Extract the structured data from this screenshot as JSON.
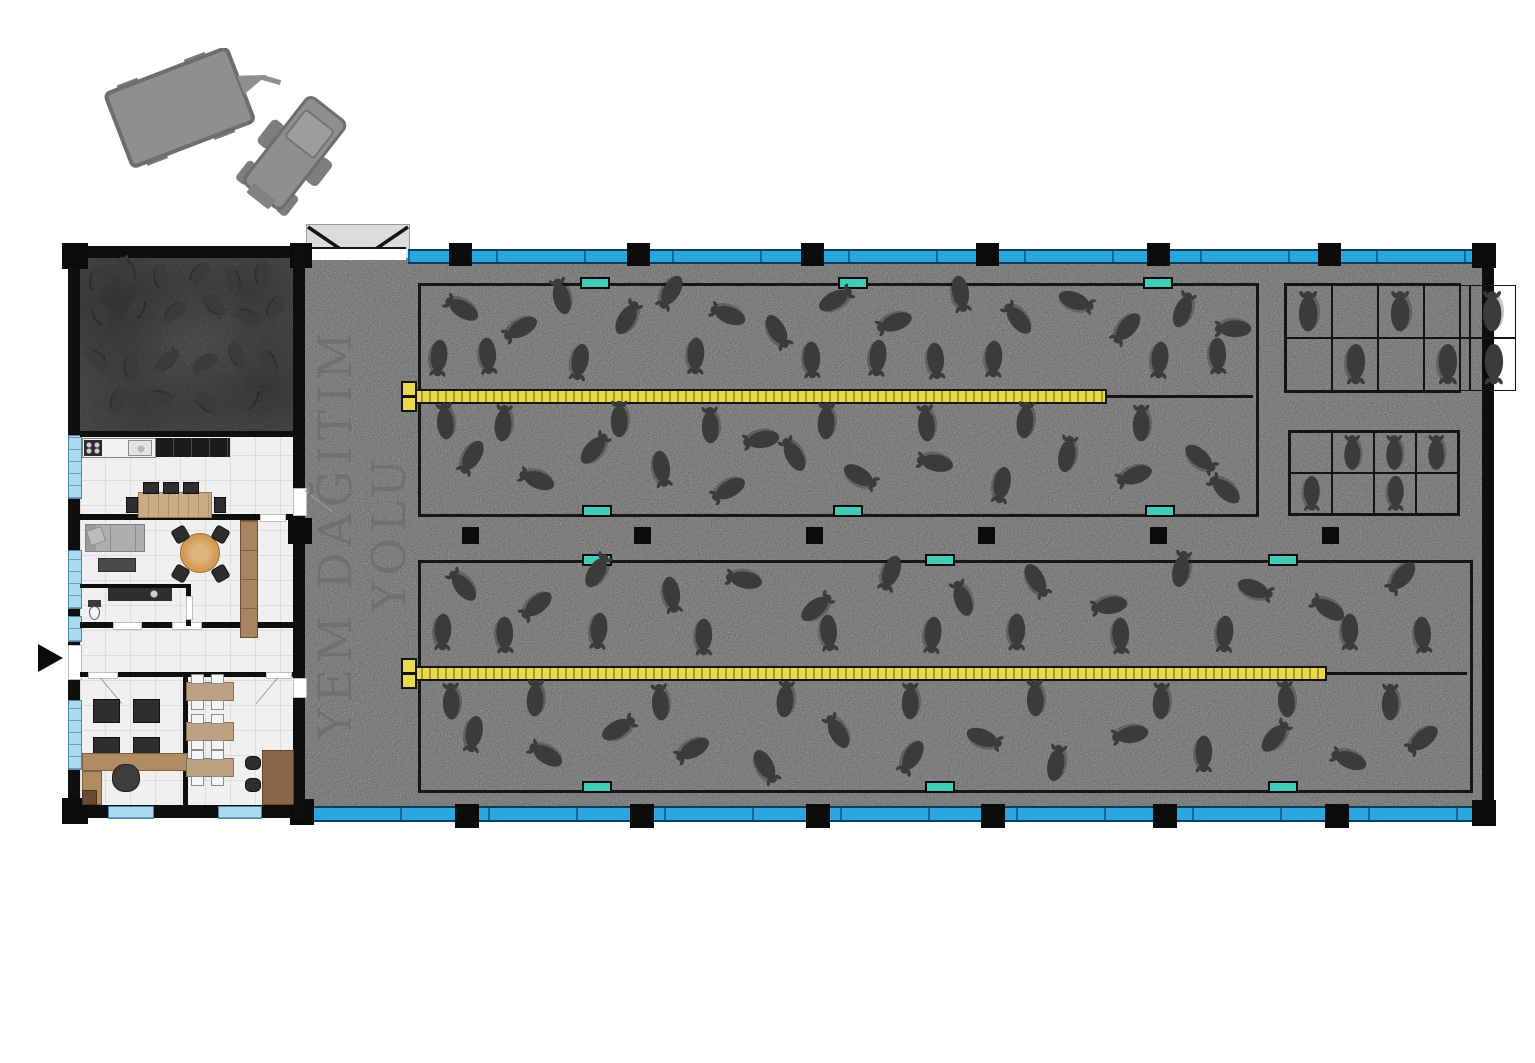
{
  "plan": {
    "corridor_label": "YEM DAĞITIM YOLU",
    "colors": {
      "wall": "#0e0e0e",
      "concrete": "#c9c9c9",
      "dark_pen_floor": "#939393",
      "window_blue": "#2aa7de",
      "window_pale": "#aad9f0",
      "water_teal": "#3fcdb7",
      "feeder_yellow": "#e9d94b",
      "sheep": "#3b3b3b",
      "tractor_gray": "#8f8f8f"
    },
    "columns": {
      "top": [
        449,
        627,
        801,
        976,
        1147,
        1318
      ],
      "bottom": [
        455,
        630,
        806,
        981,
        1153,
        1325
      ],
      "mid": [
        462,
        634,
        806,
        978,
        1150,
        1322
      ]
    },
    "water_troughs": [
      [
        580,
        277
      ],
      [
        838,
        277
      ],
      [
        1143,
        277
      ],
      [
        582,
        505
      ],
      [
        833,
        505
      ],
      [
        1145,
        505
      ],
      [
        582,
        554
      ],
      [
        925,
        554
      ],
      [
        1268,
        554
      ],
      [
        582,
        781
      ],
      [
        925,
        781
      ],
      [
        1268,
        781
      ]
    ],
    "feeders": [
      {
        "x": 405,
        "y": 389,
        "length": 702,
        "cap_x": 401,
        "cap_y": 381,
        "tail_x": 1107,
        "tail_len": 146,
        "tail_y": 395
      },
      {
        "x": 405,
        "y": 666,
        "length": 922,
        "cap_x": 401,
        "cap_y": 658,
        "tail_x": 1327,
        "tail_len": 140,
        "tail_y": 672
      }
    ],
    "sheep_zones": {
      "quarantine_pen": {
        "x": 80,
        "y": 260,
        "w": 212,
        "h": 172,
        "size": 31,
        "sheep": [
          [
            8,
            12,
            100
          ],
          [
            22,
            6,
            250
          ],
          [
            38,
            10,
            80
          ],
          [
            56,
            8,
            125
          ],
          [
            72,
            12,
            260
          ],
          [
            86,
            8,
            95
          ],
          [
            10,
            32,
            60
          ],
          [
            27,
            28,
            300
          ],
          [
            45,
            30,
            140
          ],
          [
            63,
            26,
            45
          ],
          [
            79,
            33,
            205
          ],
          [
            92,
            28,
            120
          ],
          [
            8,
            58,
            230
          ],
          [
            24,
            62,
            90
          ],
          [
            41,
            58,
            320
          ],
          [
            59,
            60,
            150
          ],
          [
            74,
            55,
            70
          ],
          [
            89,
            60,
            250
          ],
          [
            18,
            82,
            110
          ],
          [
            38,
            80,
            195
          ],
          [
            60,
            83,
            40
          ],
          [
            80,
            80,
            300
          ]
        ]
      },
      "pen1_upper": {
        "x": 421,
        "y": 286,
        "w": 829,
        "h": 100,
        "size": 40,
        "sheep": [
          [
            2,
            72,
            95
          ],
          [
            8,
            70,
            85
          ],
          [
            19,
            76,
            100
          ],
          [
            33,
            70,
            92
          ],
          [
            47,
            74,
            88
          ],
          [
            55,
            72,
            95
          ],
          [
            62,
            75,
            85
          ],
          [
            69,
            73,
            92
          ],
          [
            89,
            74,
            95
          ],
          [
            96,
            70,
            88
          ],
          [
            5,
            22,
            210
          ],
          [
            12,
            42,
            150
          ],
          [
            17,
            10,
            255
          ],
          [
            25,
            32,
            300
          ],
          [
            30,
            6,
            120
          ],
          [
            37,
            28,
            200
          ],
          [
            43,
            46,
            60
          ],
          [
            50,
            14,
            330
          ],
          [
            57,
            36,
            160
          ],
          [
            65,
            8,
            80
          ],
          [
            72,
            32,
            230
          ],
          [
            79,
            16,
            20
          ],
          [
            85,
            42,
            130
          ],
          [
            92,
            24,
            290
          ],
          [
            98,
            42,
            180
          ]
        ]
      },
      "pen1_lower": {
        "x": 421,
        "y": 407,
        "w": 829,
        "h": 100,
        "size": 40,
        "sheep": [
          [
            3,
            14,
            265
          ],
          [
            10,
            16,
            275
          ],
          [
            24,
            12,
            270
          ],
          [
            35,
            18,
            268
          ],
          [
            49,
            14,
            272
          ],
          [
            61,
            16,
            265
          ],
          [
            73,
            13,
            275
          ],
          [
            87,
            16,
            270
          ],
          [
            6,
            50,
            120
          ],
          [
            14,
            72,
            200
          ],
          [
            21,
            42,
            310
          ],
          [
            29,
            62,
            80
          ],
          [
            37,
            82,
            150
          ],
          [
            45,
            47,
            240
          ],
          [
            53,
            70,
            30
          ],
          [
            62,
            55,
            190
          ],
          [
            70,
            78,
            100
          ],
          [
            78,
            47,
            280
          ],
          [
            86,
            68,
            160
          ],
          [
            94,
            52,
            40
          ],
          [
            97,
            82,
            220
          ],
          [
            41,
            32,
            170
          ]
        ]
      },
      "pen2_upper": {
        "x": 421,
        "y": 563,
        "w": 1043,
        "h": 99,
        "size": 40,
        "sheep": [
          [
            2,
            70,
            92
          ],
          [
            8,
            73,
            88
          ],
          [
            17,
            69,
            95
          ],
          [
            27,
            75,
            90
          ],
          [
            39,
            71,
            85
          ],
          [
            49,
            73,
            95
          ],
          [
            57,
            70,
            90
          ],
          [
            67,
            74,
            88
          ],
          [
            77,
            72,
            93
          ],
          [
            89,
            70,
            90
          ],
          [
            96,
            73,
            85
          ],
          [
            4,
            22,
            230
          ],
          [
            11,
            42,
            140
          ],
          [
            17,
            8,
            300
          ],
          [
            24,
            32,
            80
          ],
          [
            31,
            16,
            190
          ],
          [
            38,
            45,
            320
          ],
          [
            45,
            10,
            110
          ],
          [
            52,
            35,
            250
          ],
          [
            59,
            18,
            60
          ],
          [
            66,
            42,
            170
          ],
          [
            73,
            6,
            280
          ],
          [
            80,
            27,
            20
          ],
          [
            87,
            45,
            210
          ],
          [
            94,
            14,
            130
          ]
        ]
      },
      "pen2_lower": {
        "x": 421,
        "y": 685,
        "w": 1043,
        "h": 98,
        "size": 40,
        "sheep": [
          [
            3,
            16,
            268
          ],
          [
            11,
            13,
            272
          ],
          [
            23,
            17,
            265
          ],
          [
            35,
            14,
            275
          ],
          [
            47,
            16,
            270
          ],
          [
            59,
            13,
            268
          ],
          [
            71,
            16,
            272
          ],
          [
            83,
            14,
            265
          ],
          [
            93,
            17,
            270
          ],
          [
            5,
            50,
            100
          ],
          [
            12,
            70,
            210
          ],
          [
            19,
            45,
            330
          ],
          [
            26,
            65,
            150
          ],
          [
            33,
            84,
            60
          ],
          [
            40,
            47,
            240
          ],
          [
            47,
            73,
            120
          ],
          [
            54,
            55,
            20
          ],
          [
            61,
            80,
            280
          ],
          [
            68,
            50,
            170
          ],
          [
            75,
            70,
            90
          ],
          [
            82,
            53,
            310
          ],
          [
            89,
            76,
            200
          ],
          [
            96,
            55,
            140
          ]
        ]
      }
    },
    "stall_grids": [
      {
        "x": 1284,
        "y": 283,
        "w": 177,
        "h": 110,
        "rows": 2,
        "cols": 5,
        "size": 44,
        "cells": [
          [
            1,
            0,
            1,
            0,
            1
          ],
          [
            0,
            2,
            0,
            2,
            2
          ]
        ]
      },
      {
        "x": 1288,
        "y": 430,
        "w": 172,
        "h": 86,
        "rows": 2,
        "cols": 4,
        "size": 38,
        "cells": [
          [
            0,
            1,
            1,
            1
          ],
          [
            2,
            0,
            2,
            0
          ]
        ]
      }
    ]
  }
}
